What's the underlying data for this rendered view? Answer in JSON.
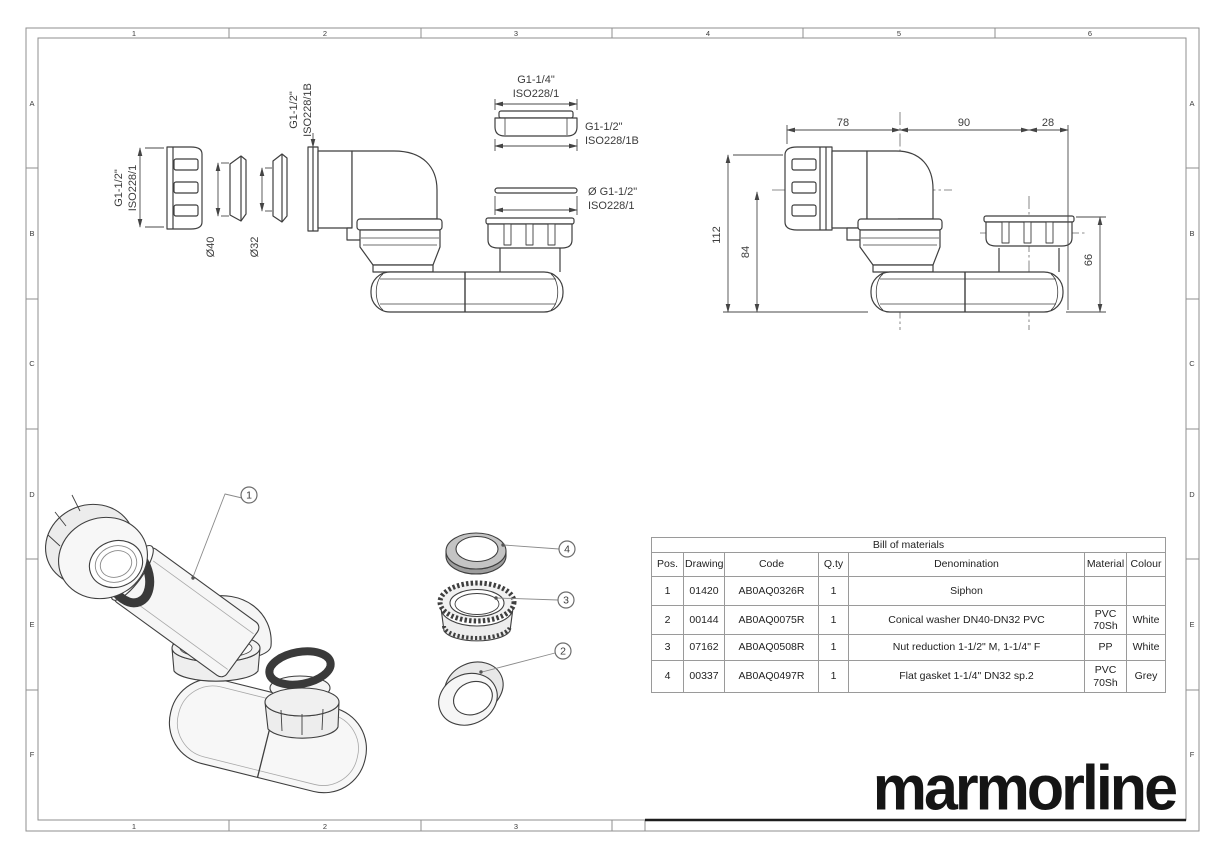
{
  "sheet": {
    "grid_cols_top": [
      "1",
      "2",
      "3",
      "4",
      "5",
      "6"
    ],
    "grid_cols_bottom": [
      "1",
      "2",
      "3"
    ],
    "grid_rows_left": [
      "A",
      "B",
      "C",
      "D",
      "E",
      "F"
    ],
    "grid_rows_right": [
      "A",
      "B",
      "C",
      "D",
      "E",
      "F"
    ]
  },
  "views": {
    "exploded_ortho": {
      "nut_thread_label_line1": "G1-1/2\"",
      "nut_thread_label_line2": "ISO228/1",
      "washer_dia_label": "Ø40",
      "gasket_dia_label": "Ø32",
      "elbow_inlet_label_line1": "G1-1/2\"",
      "elbow_inlet_label_line2": "ISO228/1B",
      "reduction_nut_label_line1": "G1-1/4\"",
      "reduction_nut_label_line2": "ISO228/1",
      "outlet_thread_label_line1": "G1-1/2\"",
      "outlet_thread_label_line2": "ISO228/1B",
      "flat_gasket_label_line1": "Ø G1-1/2\"",
      "flat_gasket_label_line2": "ISO228/1"
    },
    "assembled_ortho": {
      "dim_width_left": "78",
      "dim_width_mid": "90",
      "dim_width_right": "28",
      "dim_height_total": "112",
      "dim_height_inlet": "84",
      "dim_height_outlet": "66"
    },
    "iso_exploded": {
      "balloon_1": "1",
      "balloon_2": "2",
      "balloon_3": "3",
      "balloon_4": "4"
    }
  },
  "bom": {
    "title": "Bill of materials",
    "headers": [
      "Pos.",
      "Drawing",
      "Code",
      "Q.ty",
      "Denomination",
      "Material",
      "Colour"
    ],
    "rows": [
      {
        "pos": "1",
        "drawing": "01420",
        "code": "AB0AQ0326R",
        "qty": "1",
        "denomination": "Siphon",
        "material": "",
        "colour": ""
      },
      {
        "pos": "2",
        "drawing": "00144",
        "code": "AB0AQ0075R",
        "qty": "1",
        "denomination": "Conical washer DN40-DN32 PVC",
        "material": "PVC\n70Sh",
        "colour": "White"
      },
      {
        "pos": "3",
        "drawing": "07162",
        "code": "AB0AQ0508R",
        "qty": "1",
        "denomination": "Nut reduction 1-1/2\" M, 1-1/4\" F",
        "material": "PP",
        "colour": "White"
      },
      {
        "pos": "4",
        "drawing": "00337",
        "code": "AB0AQ0497R",
        "qty": "1",
        "denomination": "Flat gasket 1-1/4\" DN32 sp.2",
        "material": "PVC\n70Sh",
        "colour": "Grey"
      }
    ]
  },
  "brand": {
    "logo_text": "marmorline"
  },
  "colors": {
    "line": "#3f3f3f",
    "dim": "#4a4a4a",
    "frame": "#8f8f8f",
    "logo": "#151515",
    "oring_dark": "#3a3a3a",
    "part_fill": "#f5f5f5",
    "gasket_grey": "#bfbfbf"
  }
}
